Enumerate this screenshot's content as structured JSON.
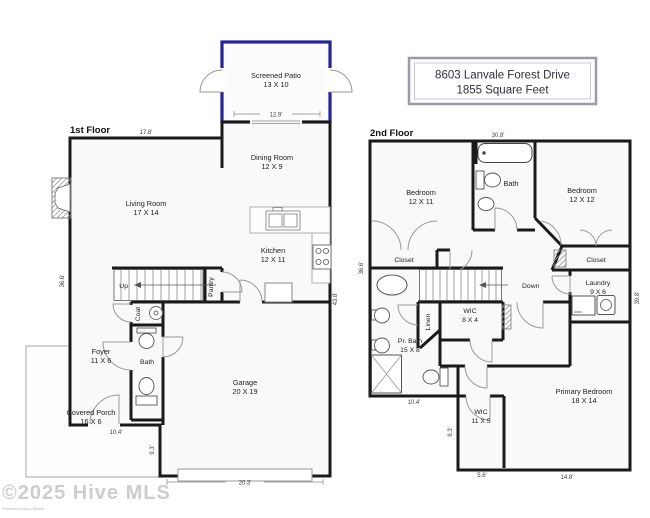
{
  "title": {
    "line1": "8603 Lanvale Forest Drive",
    "line2": "1855 Square Feet"
  },
  "watermark": {
    "main": "©2025 Hive MLS",
    "sub": "Powered by Apex Sketch"
  },
  "colors": {
    "wall": "#1a1a1a",
    "patio_outline": "#232394",
    "room_fill": "#f9f9f9"
  },
  "f1": {
    "label": "1st Floor",
    "patio": {
      "name": "Screened Patio",
      "dims": "13 X 10"
    },
    "dining": {
      "name": "Dining Room",
      "dims": "12 X 9"
    },
    "living": {
      "name": "Living Room",
      "dims": "17 X 14"
    },
    "kitchen": {
      "name": "Kitchen",
      "dims": "12 X 11"
    },
    "foyer": {
      "name": "Foyer",
      "dims": "11 X 6"
    },
    "garage": {
      "name": "Garage",
      "dims": "20 X 19"
    },
    "porch": {
      "name": "Covered Porch",
      "dims": "16 X 6"
    },
    "pantry": "Pantry",
    "coat": "Coat",
    "bath": "Bath",
    "up": "Up",
    "dims": {
      "top": "17.8'",
      "patio": "12.9'",
      "left": "36.6'",
      "right": "43.8'",
      "foyer": "10.4'",
      "garage_side": "9.3'",
      "garage": "20.3'"
    }
  },
  "f2": {
    "label": "2nd Floor",
    "bedroom1": {
      "name": "Bedroom",
      "dims": "12 X 11"
    },
    "bedroom2": {
      "name": "Bedroom",
      "dims": "12 X 12"
    },
    "laundry": {
      "name": "Laundry",
      "dims": "9 X 6"
    },
    "wic1": {
      "name": "WIC",
      "dims": "8 X 4"
    },
    "prbath": {
      "name": "Pr. Bath",
      "dims": "15 X 8"
    },
    "wic2": {
      "name": "WIC",
      "dims": "11 X 5"
    },
    "primary": {
      "name": "Primary Bedroom",
      "dims": "18 X 14"
    },
    "bath": "Bath",
    "closet1": "Closet",
    "closet2": "Closet",
    "linen": "Linen",
    "down": "Down",
    "dims": {
      "top": "30.8'",
      "left": "36.6'",
      "right": "39.8'",
      "bath": "10.4'",
      "wic_side": "8.3'",
      "wic": "5.6'",
      "primary": "14.8'"
    }
  }
}
